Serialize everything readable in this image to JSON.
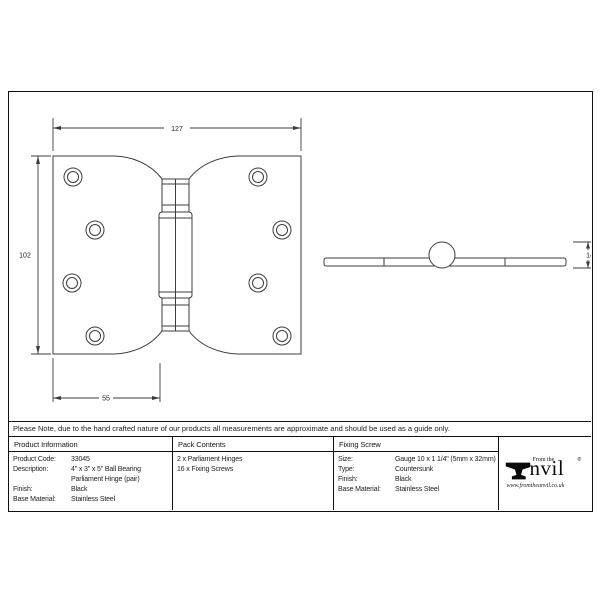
{
  "note": {
    "text": "Please Note, due to the hand crafted nature of our products all measurements are approximate and should be used as a guide only."
  },
  "drawing": {
    "front": {
      "width_label": "127",
      "height_label": "102",
      "offset_label": "55"
    },
    "side": {
      "diameter_label": "14"
    }
  },
  "table": {
    "product_information": {
      "header": "Product Information",
      "rows": [
        {
          "label": "Product Code:",
          "value": "33045"
        },
        {
          "label": "Description:",
          "value": "4\" x 3\" x 5\" Ball Bearing Parliament Hinge (pair)"
        },
        {
          "label": "Finish:",
          "value": "Black"
        },
        {
          "label": "Base Material:",
          "value": "Stainless Steel"
        }
      ]
    },
    "pack_contents": {
      "header": "Pack Contents",
      "items": [
        "2 x Parliament Hinges",
        "16 x Fixing Screws"
      ]
    },
    "fixing_screw": {
      "header": "Fixing Screw",
      "rows": [
        {
          "label": "Size:",
          "value": "Gauge 10 x 1 1/4\" (5mm x 32mm)"
        },
        {
          "label": "Type:",
          "value": "Countersunk"
        },
        {
          "label": "Finish:",
          "value": "Black"
        },
        {
          "label": "Base Material:",
          "value": "Stainless Steel"
        }
      ]
    }
  },
  "logo": {
    "prefix": "From the",
    "brand_suffix": "nvil",
    "reg": "®",
    "website": "www.fromtheanvil.co.uk"
  }
}
